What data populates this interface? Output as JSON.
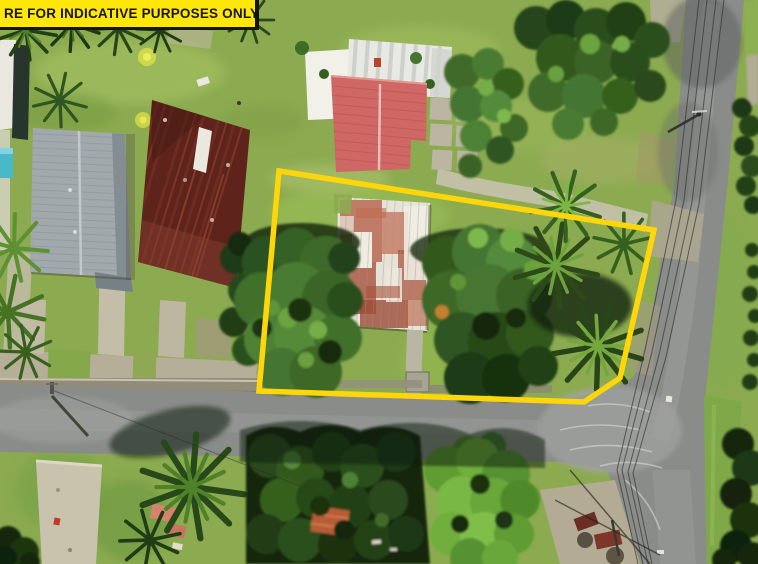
{
  "banner": {
    "label": "RE FOR INDICATIVE PURPOSES ONLY"
  },
  "colors": {
    "banner-bg": "#ffe70c",
    "banner-border": "#15150f",
    "banner-text": "#16160f",
    "boundary": "#ffd60a",
    "grass": "#8cab50",
    "road": "#8a8c8a",
    "roof-gray": "#a2a9ad",
    "roof-maroon": "#5e241c",
    "roof-red": "#cf6765",
    "roof-rusty-white": "#e7e3d8",
    "concrete": "#c6c0ac",
    "canopy-dark": "#1e3512"
  },
  "scene": {
    "kind": "aerial drone photo of a residential parcel",
    "annotation": "yellow property boundary outline",
    "features": [
      "grass lawns",
      "tin roof buildings",
      "dense tree canopy",
      "palm trees",
      "asphalt roads",
      "T-intersection",
      "power lines",
      "concrete driveways",
      "stone wall"
    ]
  }
}
